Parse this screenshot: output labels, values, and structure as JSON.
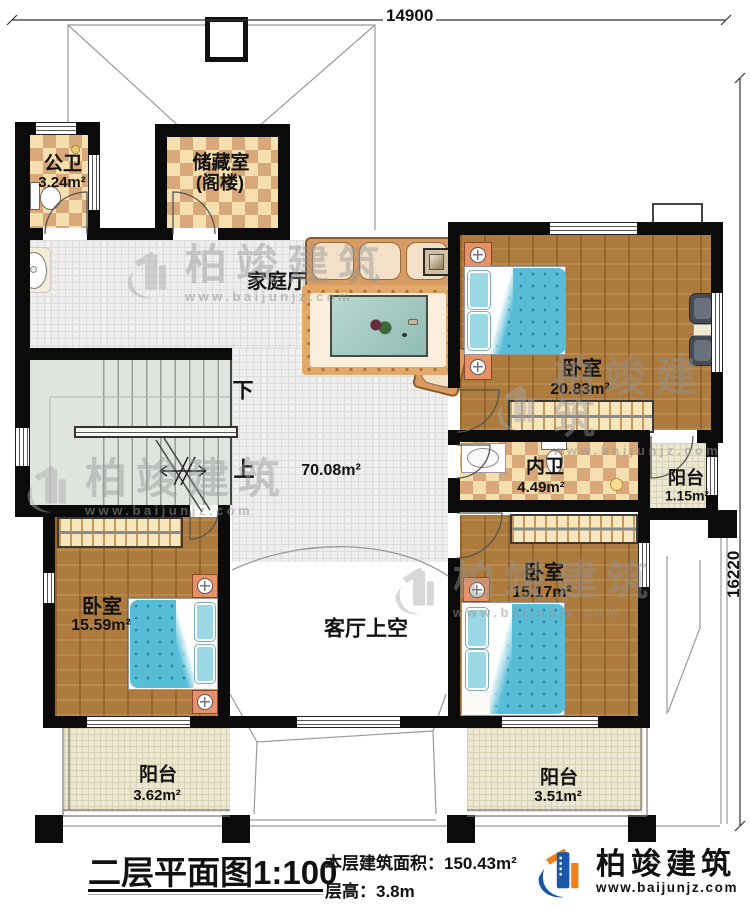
{
  "dimensions": {
    "width_top": "14900",
    "height_right": "16220"
  },
  "rooms": {
    "public_bath": {
      "name": "公卫",
      "area": "3.24m²"
    },
    "storage": {
      "name": "储藏室",
      "subname": "(阁楼)"
    },
    "family_hall": {
      "name": "家庭厅",
      "area": "70.08m²"
    },
    "bedroom_right": {
      "name": "卧室",
      "area": "20.83m²"
    },
    "ensuite_bath": {
      "name": "内卫",
      "area": "4.49m²"
    },
    "balcony_small": {
      "name": "阳台",
      "area": "1.15m²"
    },
    "bedroom_left": {
      "name": "卧室",
      "area": "15.59m²"
    },
    "bedroom_bottom": {
      "name": "卧室",
      "area": "15.17m²"
    },
    "living_void": {
      "name": "客厅上空"
    },
    "balcony_left": {
      "name": "阳台",
      "area": "3.62m²"
    },
    "balcony_right": {
      "name": "阳台",
      "area": "3.51m²"
    }
  },
  "stairs": {
    "down_label": "下",
    "up_label": "上"
  },
  "title_block": {
    "title": "二层平面图",
    "scale": "1:100",
    "area_label": "本层建筑面积：",
    "area_value": "150.43m²",
    "height_label": "层高：",
    "height_value": "3.8m"
  },
  "brand": {
    "name": "柏竣建筑",
    "website": "www.baijunjz.com"
  },
  "watermark": {
    "name": "柏竣建筑",
    "website": "www.baijunjz.com"
  },
  "colors": {
    "wall": "#0b0b0b",
    "wood_floor": "#ad7b3d",
    "checker_light": "#f6dfae",
    "checker_dark": "#d9a878",
    "hall_tile": "#efeeee",
    "balcony_tile": "#ece7d2",
    "stairs": "#dfe5de",
    "bed_blanket": "#58bed8",
    "brand_blue": "#1b57a8",
    "brand_orange": "#f08018"
  }
}
